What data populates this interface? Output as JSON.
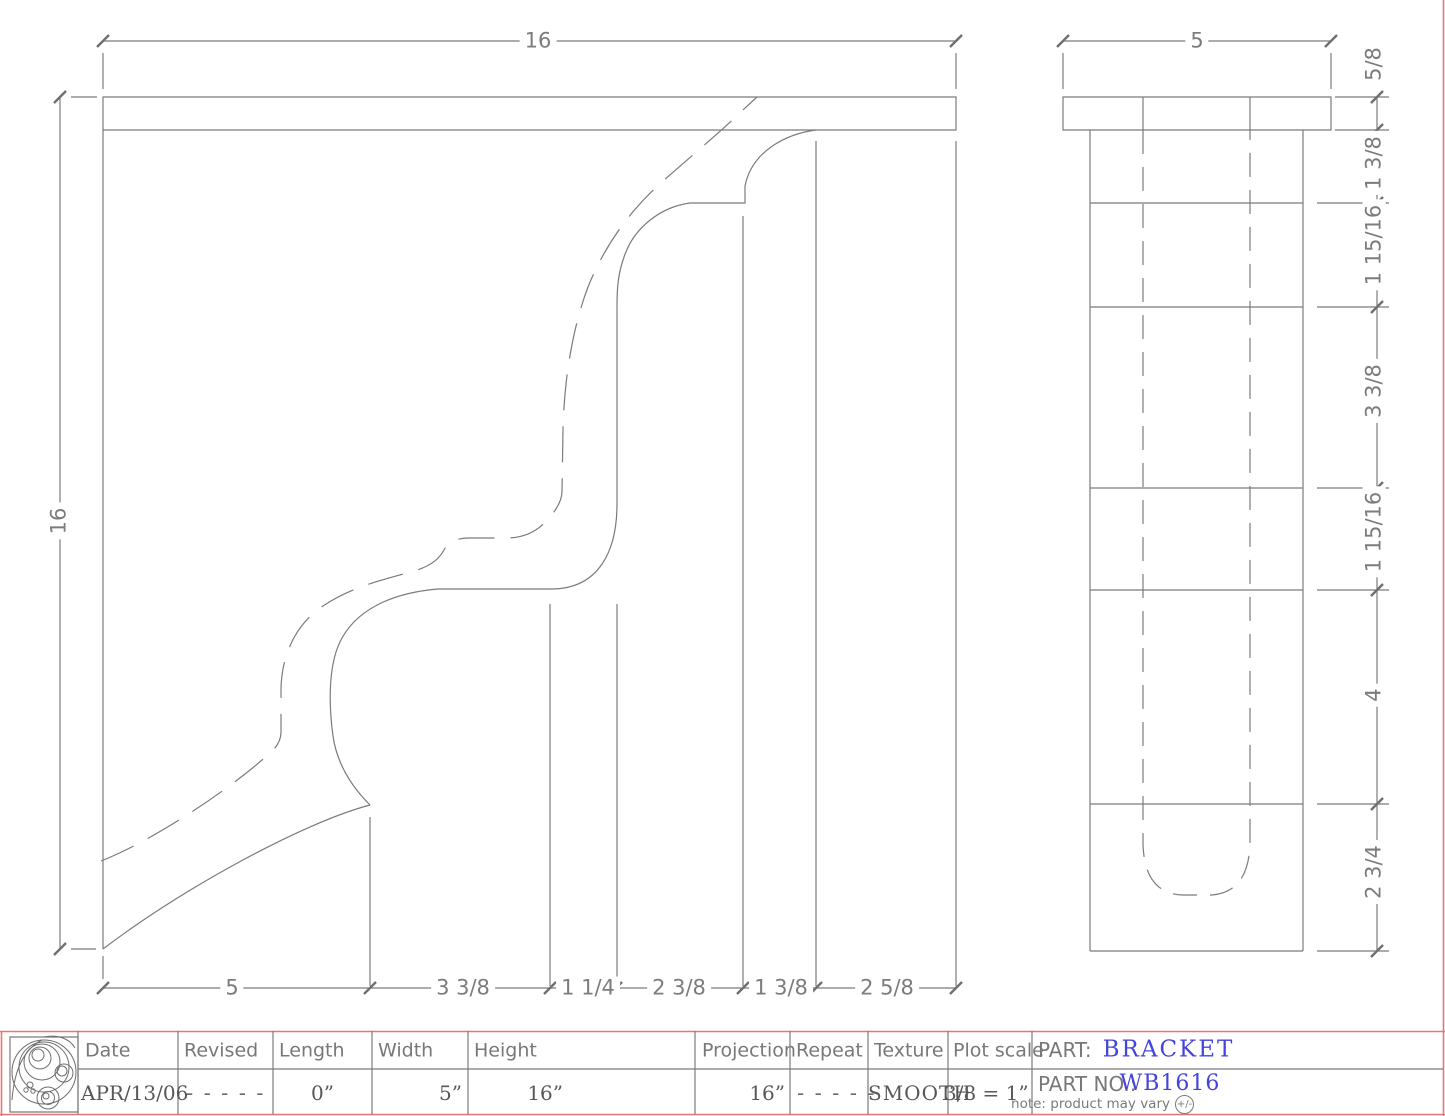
{
  "drawing": {
    "left_view": {
      "dim_top": "16",
      "dim_left": "16",
      "dims_bottom": [
        "5",
        "3 3/8",
        "1 1/4",
        "2 3/8",
        "1 3/8",
        "2 5/8"
      ]
    },
    "right_view": {
      "dim_top": "5",
      "dims_right": [
        "5/8",
        "1 3/8",
        "1 15/16",
        "3 3/8",
        "1 15/16",
        "4",
        "2 3/4"
      ]
    }
  },
  "title_block": {
    "headers": [
      "Date",
      "Revised",
      "Length",
      "Width",
      "Height",
      "Projection",
      "Repeat",
      "Texture",
      "Plot scale"
    ],
    "values": {
      "date": "APR/13/06",
      "revised": "- - - - -",
      "length": "0”",
      "width": "5”",
      "height": "16”",
      "projection": "16”",
      "repeat": "- - - - -",
      "texture": "SMOOTH",
      "plot_scale": "3/8 = 1”"
    },
    "part_label": "PART:",
    "part_value": "BRACKET",
    "part_no_label": "PART NO.:",
    "part_no_value": "WB1616",
    "note": "note: product may vary",
    "note_badge": "+/-"
  },
  "colors": {
    "line_gray": "#7b7b7b",
    "frame_red": "#ec7474",
    "part_blue": "#4444dd"
  }
}
